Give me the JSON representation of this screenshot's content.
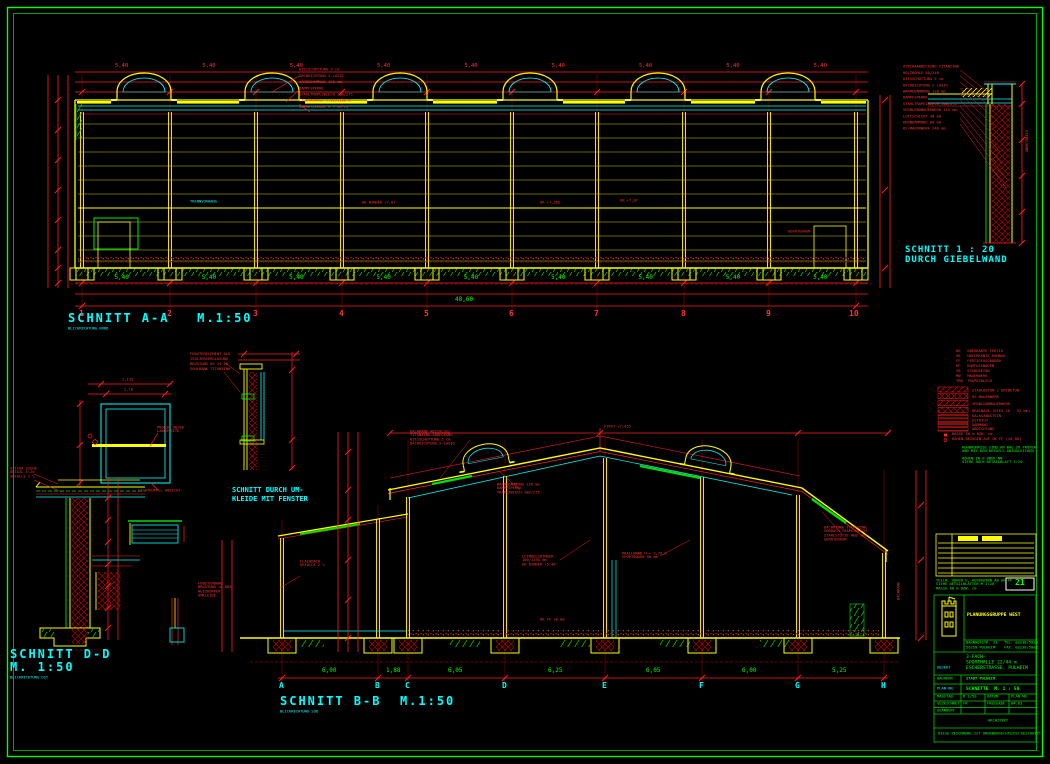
{
  "colors": {
    "background": "#000000",
    "frame_green": "#00ff00",
    "line_yellow": "#ffff00",
    "dim_red": "#ff0000",
    "text_cyan": "#00ffff",
    "value_green": "#00ff00"
  },
  "section_aa": {
    "title": "SCHNITT A-A",
    "scale": "M.1:50",
    "subtitle": "BLICKRICHTUNG NORD",
    "axes": [
      "1",
      "2",
      "3",
      "4",
      "5",
      "6",
      "7",
      "8",
      "9",
      "10"
    ],
    "bay_dims": [
      "5,40",
      "5,40",
      "5,40",
      "5,40",
      "5,40",
      "5,40",
      "5,40",
      "5,40",
      "5,40"
    ],
    "top_dims": [
      "5,40",
      "5,40",
      "5,40",
      "5,40",
      "5,40",
      "5,40",
      "5,40",
      "5,40",
      "5,40"
    ],
    "total_dim": "48,60",
    "roof_callouts": [
      "KIESSCHÜTTUNG 5 cm",
      "DACHDICHTUNG 2-LAGIG",
      "WÄRMEDÄMMUNG 120 mm",
      "DAMPFSPERRE",
      "STAHLTRAPEZBLECH 100/275",
      "LICHTKUPPEL 1,80/1,80 m",
      "AUFSETZKRANZ H = 30 cm"
    ],
    "elev_label_1": "UK BINDER +7,07",
    "elev_label_2": "OK +7,265",
    "elev_label_3": "UK +7,07",
    "curtain_label": "TRENNVORHANG",
    "room_label": "GERÄTERAUM"
  },
  "detail_giebel": {
    "title_line1": "SCHNITT 1 : 20",
    "title_line2": "DURCH GIEBELWAND",
    "callouts": [
      "ATTIKAABDECKUNG TITANZINK",
      "HOLZBOHLE 50/240",
      "KIESSCHÜTTUNG 5 cm",
      "DACHDICHTUNG 2-LAGIG",
      "WÄRMEDÄMMUNG 120 mm",
      "DAMPFSPERRE",
      "STAHLTRAPEZBLECH 100/275",
      "VERBLENDMAUERWERK 115 mm",
      "LUFTSCHICHT 40 mm",
      "KERNDÄMMUNG 60 mm",
      "KS-MAUERWERK 240 mm"
    ],
    "side_label": "GIEBELWAND"
  },
  "detail_sky": {
    "dim_top": "2,135",
    "dim_mid": "2,10",
    "profil_lines": [
      "PROFIL 40/80",
      "LÄNGSSEITE"
    ],
    "caption": "LICHTKUPPEL ANSICHT"
  },
  "detail_umkleide": {
    "title_line1": "SCHNITT DURCH UM-",
    "title_line2": "KLEIDE MIT FENSTER",
    "callouts": [
      "FENSTERELEMENT ALU",
      "ISOLIERVERGLASUNG",
      "BRÜSTUNG KS 24 cm",
      "SOHLBANK TITANZINK"
    ]
  },
  "section_dd": {
    "title": "SCHNITT D-D",
    "scale": "M. 1:50",
    "subtitle": "BLICKRICHTUNG OST",
    "callouts": [
      "ATTIKA SIEHE",
      "DETAIL 1:20",
      "GEFÄLLE 2 %"
    ]
  },
  "section_bb": {
    "title": "SCHNITT B-B",
    "scale": "M.1:50",
    "subtitle": "BLICKRICHTUNG SÜD",
    "axes": [
      "A",
      "B",
      "C",
      "D",
      "E",
      "F",
      "G",
      "H"
    ],
    "bay_dims": [
      "6,00",
      "1,88",
      "6,05",
      "6,25",
      "6,05",
      "6,00",
      "5,25"
    ],
    "apex_label": "FIRST +7,435",
    "floor_label": "OK FF ±0,00",
    "side_label": "DACHRAND",
    "eave_left_callouts": [
      "DACHRAND-ABSCHLUSS",
      "TITANZINK-ABDECKUNG",
      "KIESSCHÜTTUNG 5 cm",
      "DACHDICHTUNG 2-LAGIG"
    ],
    "slope_callouts": [
      "WÄRMEDÄMMUNG 120 mm",
      "DAMPFSPERRE",
      "TRAPEZBLECH 100/275"
    ],
    "mid_callouts": [
      "LEIMHOLZBINDER",
      "100/1250 mm",
      "UK BINDER +5,48"
    ],
    "mid2_callouts": [
      "PRALLWAND H = 2,75 m",
      "SPORTBODEN 90 mm"
    ],
    "eave_right_callouts": [
      "DACHRINNE TITANZINK",
      "VORDACH TRAPEZBLECH",
      "STAHLSTÜTZE HEB 160",
      "GERÄTERAUM"
    ],
    "annex_callouts": [
      "FENSTERBAND",
      "BRÜSTUNG +0,885",
      "HEIZKÖRPER",
      "UMKLEIDE"
    ],
    "annex2_callouts": [
      "FLACHDACH",
      "GEFÄLLE 2 %"
    ]
  },
  "legend": {
    "abbreviations": [
      "OK   OBERKANTE FERTIG",
      "UK   UNTERKANTE ROHBAU",
      "FF   FERTIGFUSSBODEN",
      "RF   ROHFUSSBODEN",
      "SB   STAHLBETON",
      "MW   MAUERWERK",
      "TRB  TRAPEZBLECH"
    ],
    "hatch_labels": [
      "STAHLBETON / ORTBETON",
      "KS-MAUERWERK",
      "VERBLENDMAUERWERK",
      "DRAINAGE (KIES 16 - 32 mm)"
    ],
    "lined_labels": [
      "KALKSANDSTEIN",
      "ESTRICH",
      "DÄMMUNG",
      "ABDICHTUNG"
    ],
    "symbol_labels": [
      "MASSE IN m BZW. cm",
      "HÖHEN BEZOGEN AUF OK FF (±0,00)"
    ],
    "note1_lines": [
      "ROHBAUMASSE SIND AM BAU ZU PRÜFEN",
      "UND MIT DEN DETAILS ABZUGLEICHEN"
    ],
    "note2_lines": [
      "HÖHEN IN m ÜBER NN",
      "SIEHE AUCH DETAILBLATT 1:20"
    ]
  },
  "revision": {
    "note_lines": [
      "TEILW. HÖHEN U. AUFBAUTEN AB OK FF",
      "SIEHE DETAILBLÄTTER M 1:20",
      "MASSE IN m BZW. cm"
    ],
    "sheet_no": "21"
  },
  "title_block": {
    "firm": "PLANUNGSGRUPPE WEST",
    "contact_line1": "BAHNHOFSTR. 31   TEL: 02238/5010",
    "contact_line2": "50259 PULHEIM    FAX: 02238/5012",
    "objekt_label": "OBJEKT",
    "project_lines": [
      "3-FACH-",
      "SPORTHALLE 22/44 m",
      "ESCHERSTRASSE, PULHEIM"
    ],
    "bauherr_label": "BAUHERR",
    "bauherr_value": "STADT PULHEIM",
    "plan_label": "PLAN-NR.",
    "plan_value": "SCHNITTE  M. 1 : 50",
    "masstab_label": "MASSTAB",
    "masstab_value": "M 1/50",
    "datum_label": "DATUM",
    "plannr_label": "PLAN-NR",
    "gezeichnet_label": "GEZEICHNET",
    "gezeichnet_value": "FR",
    "freigabe_label": "FREIGABE",
    "freigabe_value": "04.03",
    "geaendert_label": "GEÄNDERT",
    "architekt_label": "ARCHITEKT",
    "footer": "DIESE ZEICHNUNG IST URHEBERRECHTLICH GESCHÜTZT"
  }
}
